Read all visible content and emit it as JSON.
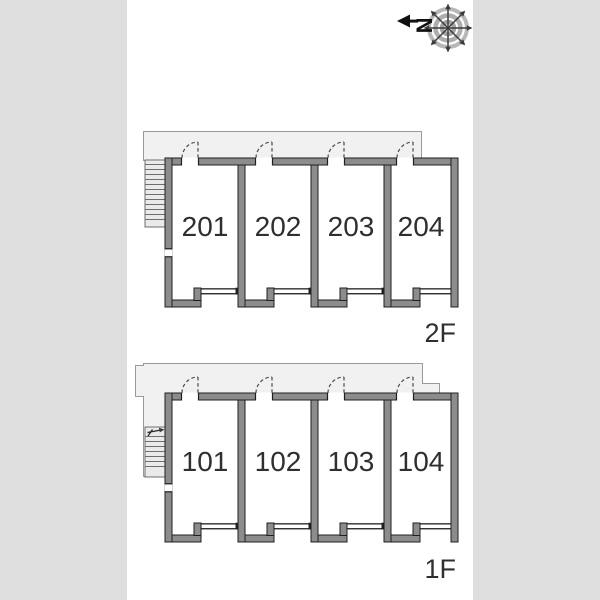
{
  "page": {
    "background_color": "#dedede",
    "paper_color": "#ffffff",
    "type": "apartment floor plan"
  },
  "compass": {
    "north_label": "N",
    "points_direction": "left"
  },
  "floors": [
    {
      "label": "2F",
      "units": [
        {
          "label": "201"
        },
        {
          "label": "202"
        },
        {
          "label": "203"
        },
        {
          "label": "204"
        }
      ]
    },
    {
      "label": "1F",
      "units": [
        {
          "label": "101"
        },
        {
          "label": "102"
        },
        {
          "label": "103"
        },
        {
          "label": "104"
        }
      ]
    }
  ],
  "colors": {
    "wall_fill": "#8c8c8c",
    "wall_edge": "#1f1f1f",
    "corridor_fill": "#f1f1f1",
    "corridor_edge": "#9a9a9a",
    "text": "#2f2f2f"
  }
}
